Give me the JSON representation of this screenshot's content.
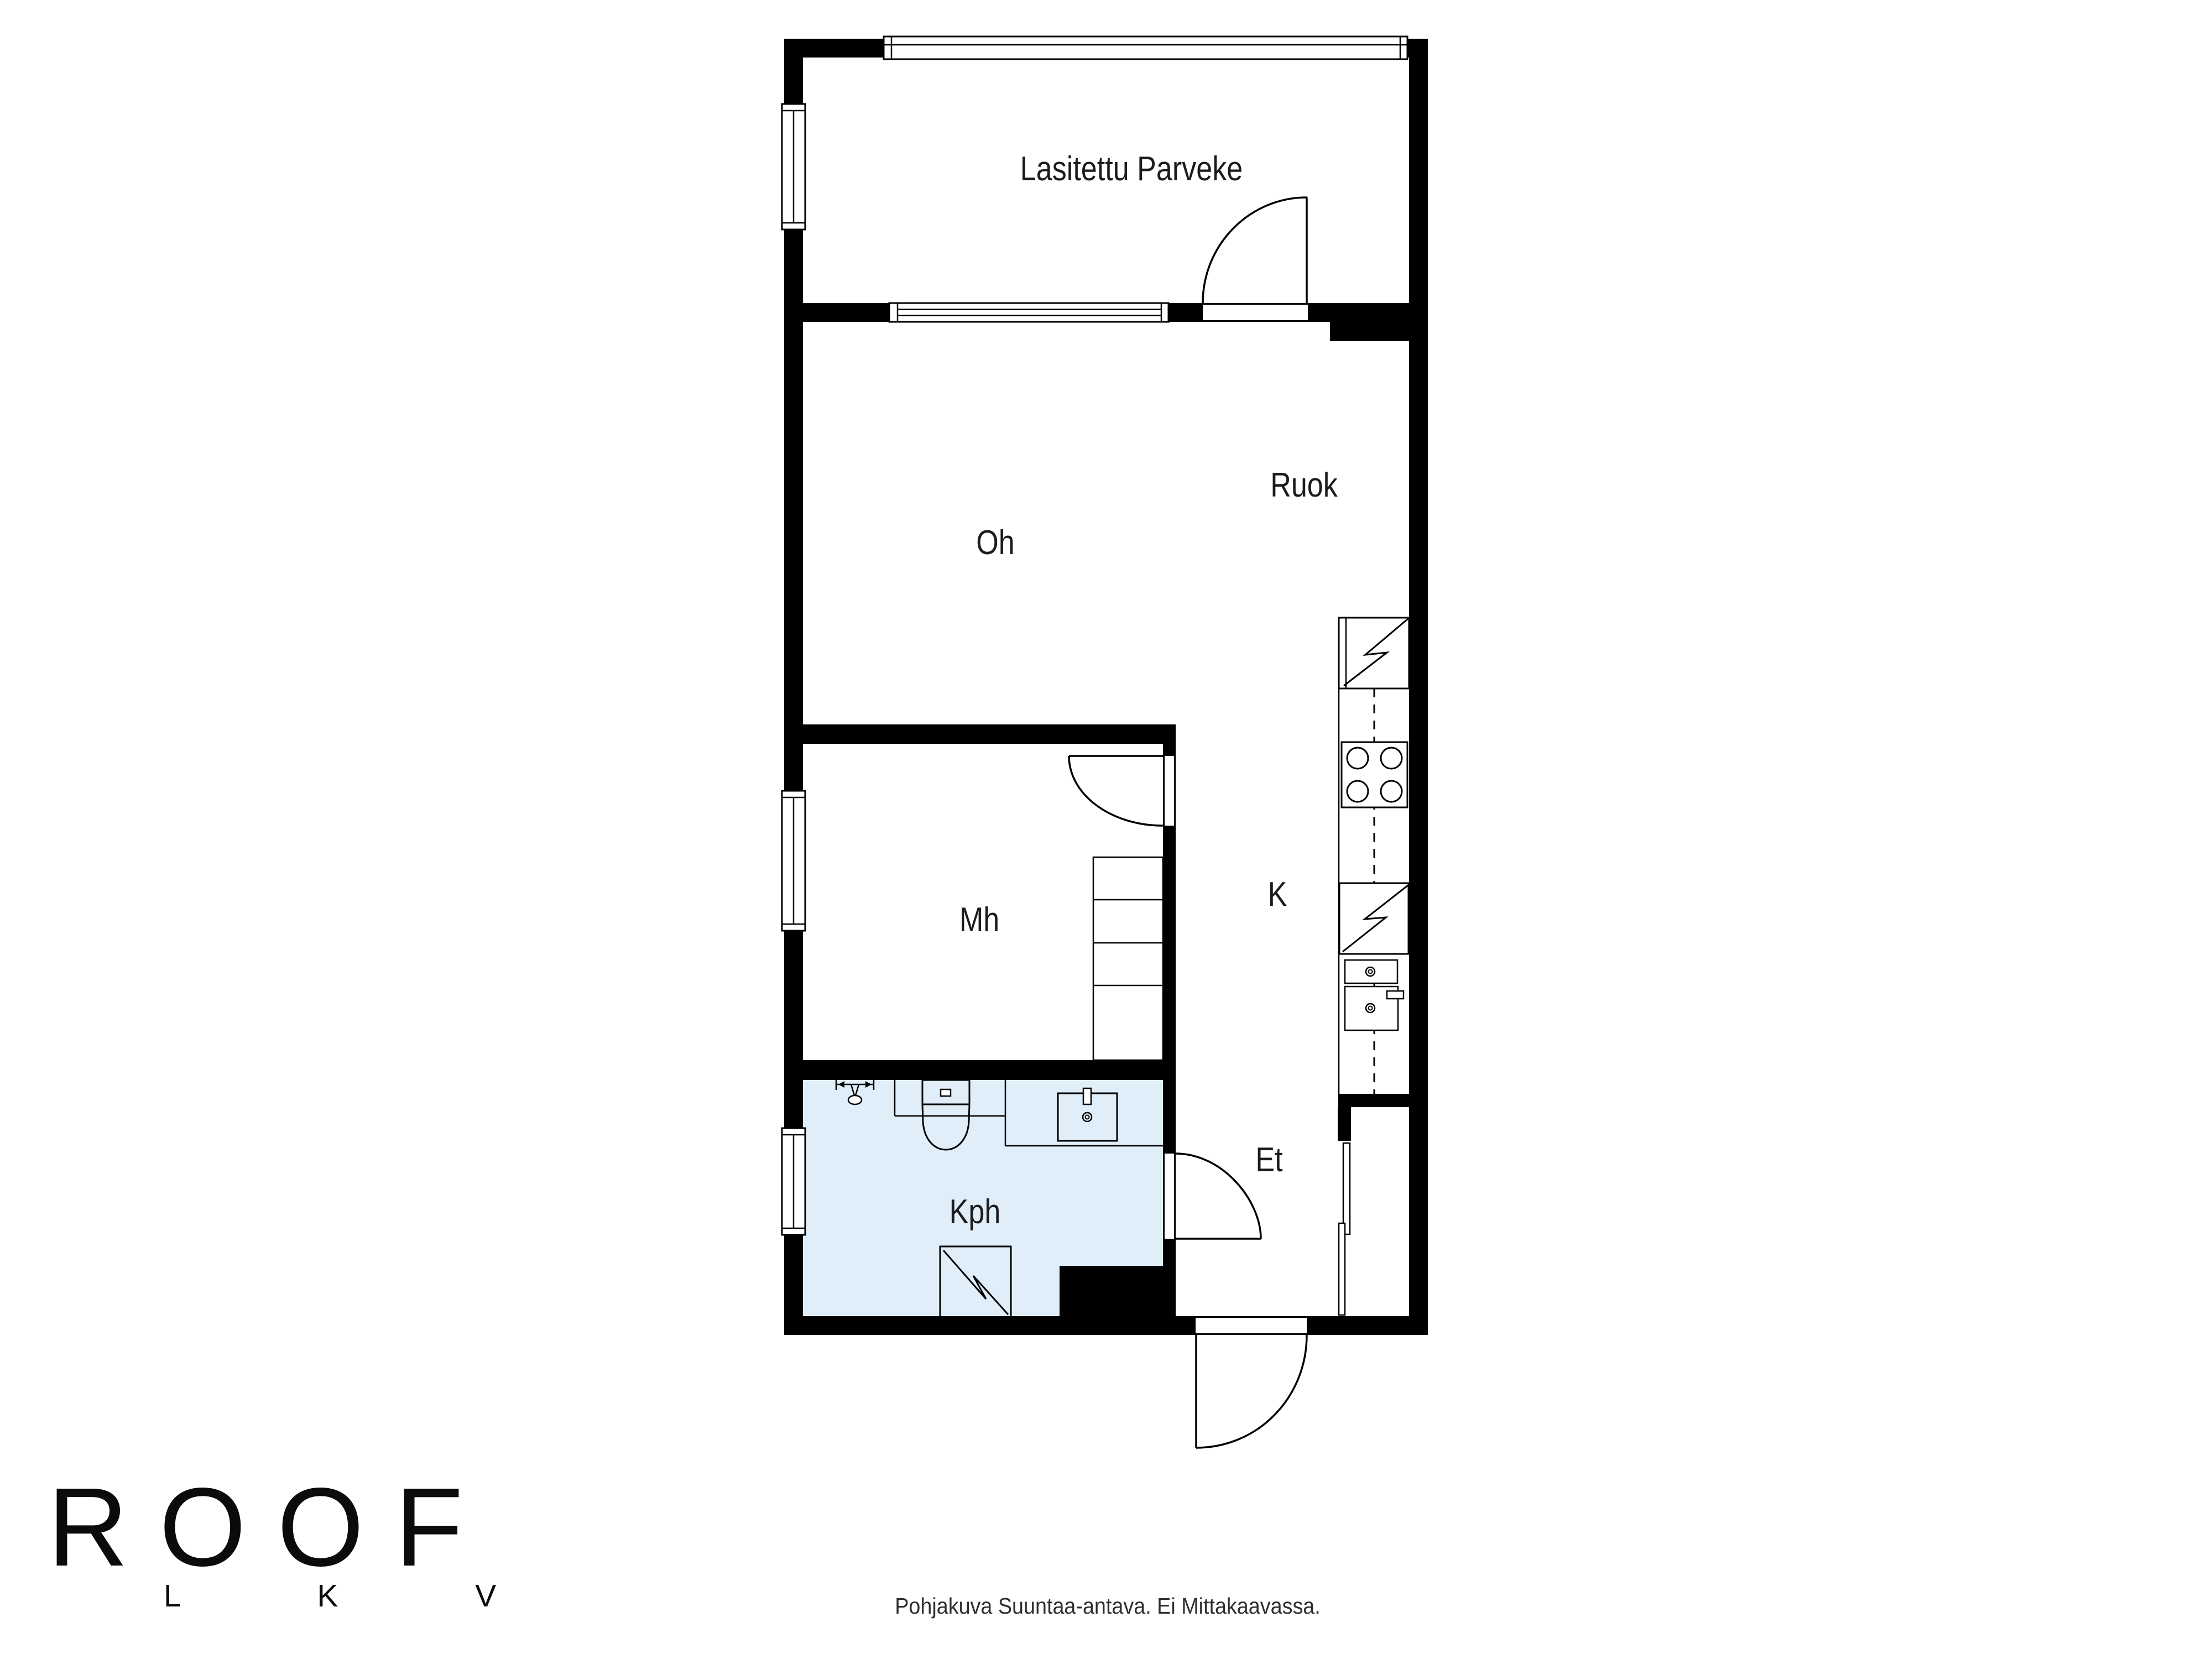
{
  "colors": {
    "wall": "#000000",
    "line": "#000000",
    "bathroom_fill": "#e0eefa",
    "text": "#1c1c1c",
    "bg": "#ffffff"
  },
  "rooms": [
    {
      "id": "lasitettu-parveke",
      "label": "Lasitettu Parveke"
    },
    {
      "id": "oh",
      "label": "Oh"
    },
    {
      "id": "ruok",
      "label": "Ruok"
    },
    {
      "id": "mh",
      "label": "Mh"
    },
    {
      "id": "k",
      "label": "K"
    },
    {
      "id": "et",
      "label": "Et"
    },
    {
      "id": "kph",
      "label": "Kph"
    }
  ],
  "branding": {
    "logo_text": "ROOF",
    "logo_sub": "L K V"
  },
  "footer": {
    "disclaimer": "Pohjakuva Suuntaa-antava. Ei Mittakaavassa."
  }
}
